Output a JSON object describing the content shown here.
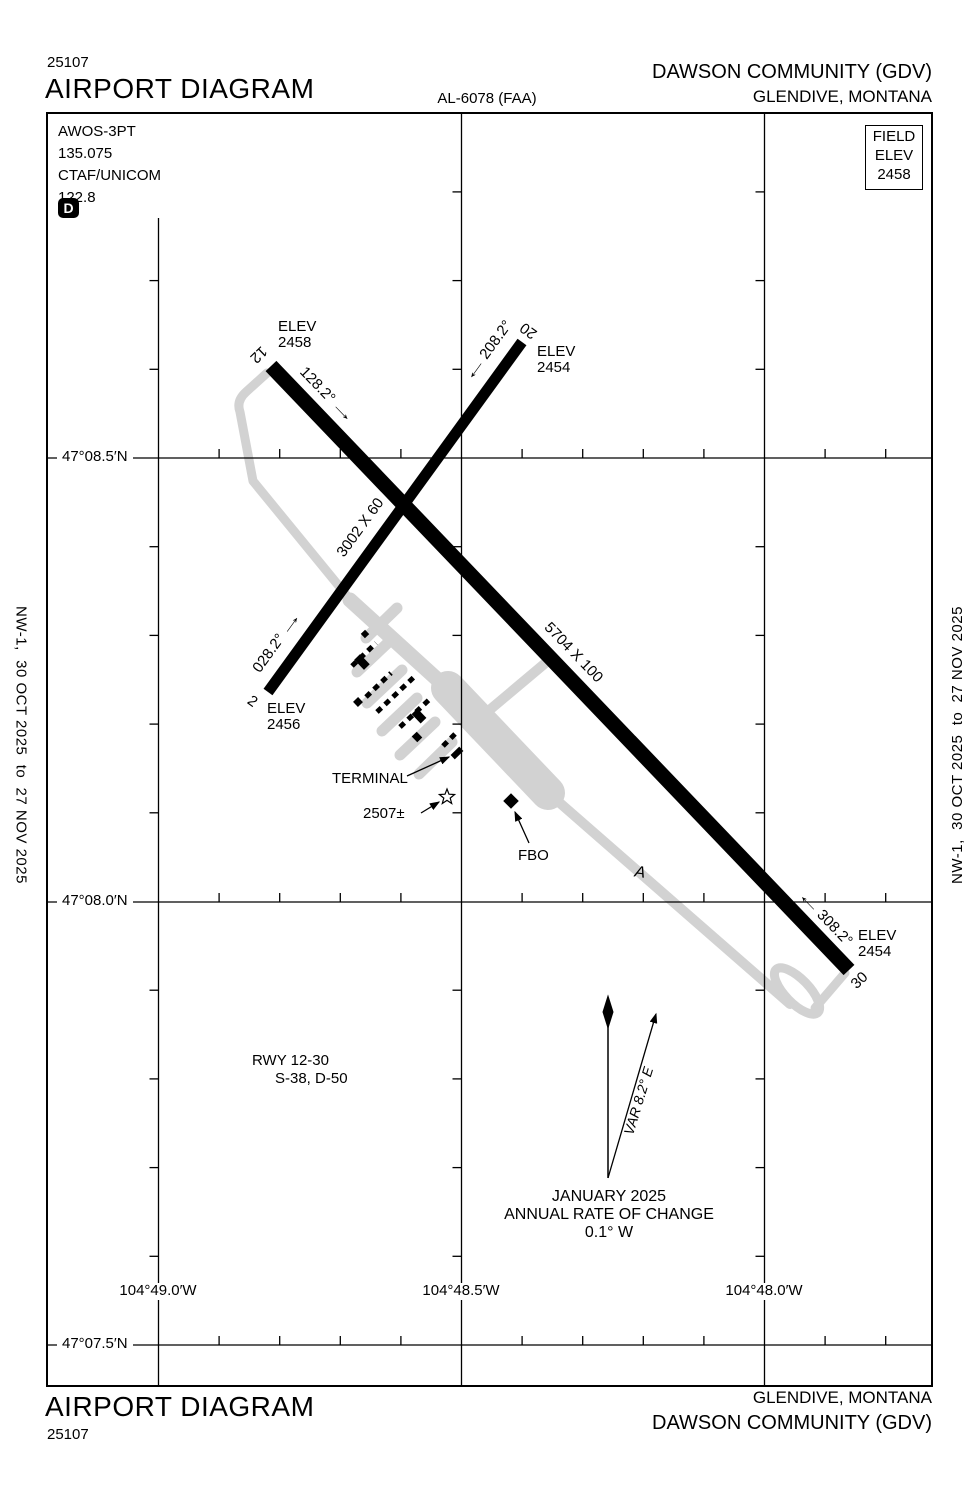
{
  "header": {
    "chart_number": "25107",
    "title": "AIRPORT DIAGRAM",
    "procedure_id": "AL-6078 (FAA)",
    "airport_name": "DAWSON COMMUNITY (GDV)",
    "city_state": "GLENDIVE, MONTANA"
  },
  "comm_box": {
    "awos_label": "AWOS-3PT",
    "awos_freq": "135.075",
    "ctaf_label": "CTAF/UNICOM",
    "ctaf_freq": "122.8",
    "hot_spot_symbol": "D"
  },
  "field_elevation_box": {
    "label_line1": "FIELD",
    "label_line2": "ELEV",
    "value": "2458"
  },
  "grid": {
    "latitude_labels": [
      "47°08.5′N",
      "47°08.0′N",
      "47°07.5′N"
    ],
    "longitude_labels": [
      "104°49.0′W",
      "104°48.5′W",
      "104°48.0′W"
    ]
  },
  "runways": {
    "runway_12_30": {
      "size_label": "5704 X 100",
      "end_12": {
        "number": "12",
        "elev_label": "ELEV",
        "elevation": "2458",
        "heading": "128.2°"
      },
      "end_30": {
        "number": "30",
        "elev_label": "ELEV",
        "elevation": "2454",
        "heading": "308.2°"
      }
    },
    "runway_2_20": {
      "size_label": "3002 X 60",
      "end_2": {
        "number": "2",
        "elev_label": "ELEV",
        "elevation": "2456",
        "heading": "028.2°"
      },
      "end_20": {
        "number": "20",
        "elev_label": "ELEV",
        "elevation": "2454",
        "heading": "208.2°"
      }
    }
  },
  "apron_labels": {
    "terminal": "TERMINAL",
    "obstruction_elevation": "2507±",
    "fbo": "FBO",
    "taxiway": "A"
  },
  "runway_data_block": {
    "runway": "RWY 12-30",
    "weight_ratings": "S-38, D-50"
  },
  "magnetic_variation": {
    "var": "VAR 8.2° E",
    "date": "JANUARY 2025",
    "annual_rate_label": "ANNUAL RATE OF CHANGE",
    "annual_rate_value": "0.1° W"
  },
  "margins": {
    "left_vertical": "NW-1,  30 OCT 2025  to  27 NOV 2025",
    "right_vertical": "NW-1,  30 OCT 2025  to  27 NOV 2025"
  },
  "footer": {
    "title": "AIRPORT DIAGRAM",
    "chart_number": "25107",
    "city_state": "GLENDIVE, MONTANA",
    "airport_name": "DAWSON COMMUNITY (GDV)"
  },
  "icons": {
    "arrow_right": "→",
    "arrow_left": "←"
  }
}
